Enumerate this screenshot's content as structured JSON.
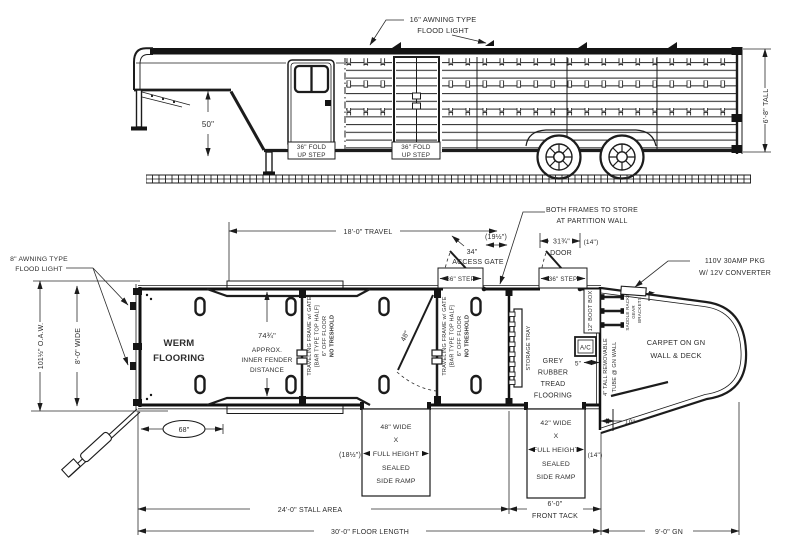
{
  "side_view": {
    "flood_light_note": {
      "line1": "16\" AWNING TYPE",
      "line2": "FLOOD LIGHT"
    },
    "height_dim": "6'-8\" TALL",
    "drop_dim": "50\"",
    "front_step": {
      "line1": "36\" FOLD",
      "line2": "UP STEP"
    },
    "rear_step": {
      "line1": "36\" FOLD",
      "line2": "UP STEP"
    }
  },
  "floor_plan": {
    "rear_flood_light_note": {
      "line1": "8\" AWNING TYPE",
      "line2": "FLOOD LIGHT"
    },
    "overall_width_dim": "101½\" O.A.W.",
    "inner_width_dim": "8'-0\" WIDE",
    "travel_dim": "18'-0\" TRAVEL",
    "access_gate": {
      "width_dim": "34\"",
      "label": "ACCESS GATE",
      "gap_dim": "(19½\")"
    },
    "step_label_1": "36\" STEP",
    "step_label_2": "36\" STEP",
    "door": {
      "width_dim": "31¾\"",
      "label": "DOOR",
      "gap_dim": "(14\")"
    },
    "frames_note": {
      "line1": "BOTH FRAMES TO STORE",
      "line2": "AT PARTITION WALL"
    },
    "power_note": {
      "line1": "110V 30AMP PKG",
      "line2": "W/ 12V CONVERTER"
    },
    "werm_flooring": {
      "line1": "WERM",
      "line2": "FLOORING"
    },
    "fender_dim": {
      "value": "74¾\"",
      "line1": "APPROX.",
      "line2": "INNER FENDER",
      "line3": "DISTANCE"
    },
    "traveling_gate_note": {
      "line1": "TRAVELING FRAME w/ GATE",
      "line2": "[BAR TYPE TOP HALF]",
      "line3": "6\" OFF FLOOR",
      "line4": "NO TRESHOLD"
    },
    "gate_swing_dim": "48\"",
    "storage_tray_label": "STORAGE TRAY",
    "grey_flooring": {
      "line1": "GREY",
      "line2": "RUBBER",
      "line3": "TREAD",
      "line4": "FLOORING"
    },
    "boot_box_label": "12\" BOOT BOX",
    "ac_label": "A/C",
    "ac_gap_dim": "5\"",
    "tube_note": {
      "line1": "4\" TALL REMOVABLE",
      "line2": "TUBE @ GN WALL"
    },
    "carpet_note": {
      "line1": "CARPET ON GN",
      "line2": "WALL & DECK"
    },
    "saddle_rack_labels": {
      "line1": "SADDLE RACKS",
      "line2": "GEAR",
      "line3": "BRACKETS"
    },
    "rear_balloon_dim": "68\"",
    "ramp_48": {
      "line1": "48\" WIDE",
      "line2": "X",
      "line3": "FULL HEIGHT",
      "line4": "SEALED",
      "line5": "SIDE RAMP",
      "gap_dim": "(18½\")"
    },
    "ramp_42": {
      "line1": "42\" WIDE",
      "line2": "X",
      "line3": "FULL HEIGHT",
      "line4": "SEALED",
      "line5": "SIDE RAMP",
      "gap_dim": "(14\")"
    },
    "gn_step_dim": "10\"",
    "stall_area_dim": "24'-0\" STALL AREA",
    "front_tack_dim": {
      "line1": "6'-0\"",
      "line2": "FRONT TACK"
    },
    "floor_length_dim": "30'-0\" FLOOR LENGTH",
    "gn_length_dim": "9'-0\" GN"
  },
  "colors": {
    "line": "#1c1c1c",
    "text": "#2d2d2d",
    "background": "#ffffff"
  }
}
